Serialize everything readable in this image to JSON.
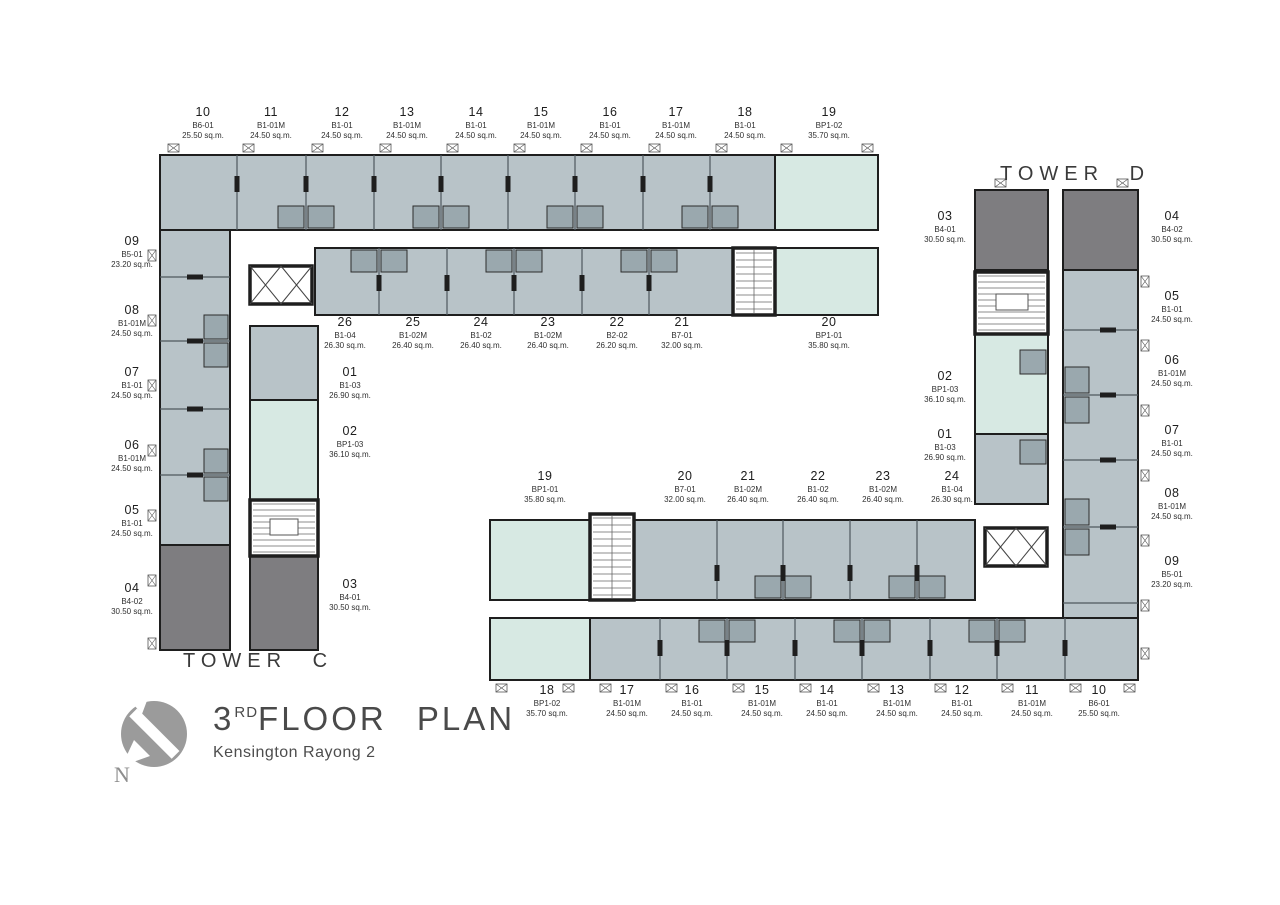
{
  "title": {
    "floor_number": "3",
    "floor_ordinal": "RD",
    "floor_text": "FLOOR  PLAN",
    "project": "Kensington Rayong 2"
  },
  "towers": {
    "c_label": "TOWER  C",
    "d_label": "TOWER  D"
  },
  "compass": {
    "letter": "N"
  },
  "colors": {
    "unit_gray": "#b8c3c8",
    "unit_mint": "#d7e9e3",
    "unit_dark": "#7e7d80",
    "wall": "#1e1e1e",
    "bath": "#9aa8ae",
    "partition": "#4e585d",
    "tread": "#666666"
  },
  "units": [
    {
      "tower": "C",
      "no": "10",
      "type": "B6-01",
      "area": "25.50 sq.m.",
      "x": 203,
      "y": 106
    },
    {
      "tower": "C",
      "no": "11",
      "type": "B1-01M",
      "area": "24.50 sq.m.",
      "x": 271,
      "y": 106
    },
    {
      "tower": "C",
      "no": "12",
      "type": "B1-01",
      "area": "24.50 sq.m.",
      "x": 342,
      "y": 106
    },
    {
      "tower": "C",
      "no": "13",
      "type": "B1-01M",
      "area": "24.50 sq.m.",
      "x": 407,
      "y": 106
    },
    {
      "tower": "C",
      "no": "14",
      "type": "B1-01",
      "area": "24.50 sq.m.",
      "x": 476,
      "y": 106
    },
    {
      "tower": "C",
      "no": "15",
      "type": "B1-01M",
      "area": "24.50 sq.m.",
      "x": 541,
      "y": 106
    },
    {
      "tower": "C",
      "no": "16",
      "type": "B1-01",
      "area": "24.50 sq.m.",
      "x": 610,
      "y": 106
    },
    {
      "tower": "C",
      "no": "17",
      "type": "B1-01M",
      "area": "24.50 sq.m.",
      "x": 676,
      "y": 106
    },
    {
      "tower": "C",
      "no": "18",
      "type": "B1-01",
      "area": "24.50 sq.m.",
      "x": 745,
      "y": 106
    },
    {
      "tower": "C",
      "no": "19",
      "type": "BP1-02",
      "area": "35.70 sq.m.",
      "x": 829,
      "y": 106
    },
    {
      "tower": "C",
      "no": "09",
      "type": "B5-01",
      "area": "23.20 sq.m.",
      "x": 132,
      "y": 235
    },
    {
      "tower": "C",
      "no": "08",
      "type": "B1-01M",
      "area": "24.50 sq.m.",
      "x": 132,
      "y": 304
    },
    {
      "tower": "C",
      "no": "07",
      "type": "B1-01",
      "area": "24.50 sq.m.",
      "x": 132,
      "y": 366
    },
    {
      "tower": "C",
      "no": "06",
      "type": "B1-01M",
      "area": "24.50 sq.m.",
      "x": 132,
      "y": 439
    },
    {
      "tower": "C",
      "no": "05",
      "type": "B1-01",
      "area": "24.50 sq.m.",
      "x": 132,
      "y": 504
    },
    {
      "tower": "C",
      "no": "04",
      "type": "B4-02",
      "area": "30.50 sq.m.",
      "x": 132,
      "y": 582
    },
    {
      "tower": "C",
      "no": "26",
      "type": "B1-04",
      "area": "26.30 sq.m.",
      "x": 345,
      "y": 316
    },
    {
      "tower": "C",
      "no": "25",
      "type": "B1-02M",
      "area": "26.40 sq.m.",
      "x": 413,
      "y": 316
    },
    {
      "tower": "C",
      "no": "24",
      "type": "B1-02",
      "area": "26.40 sq.m.",
      "x": 481,
      "y": 316
    },
    {
      "tower": "C",
      "no": "23",
      "type": "B1-02M",
      "area": "26.40 sq.m.",
      "x": 548,
      "y": 316
    },
    {
      "tower": "C",
      "no": "22",
      "type": "B2-02",
      "area": "26.20 sq.m.",
      "x": 617,
      "y": 316
    },
    {
      "tower": "C",
      "no": "21",
      "type": "B7-01",
      "area": "32.00 sq.m.",
      "x": 682,
      "y": 316
    },
    {
      "tower": "C",
      "no": "20",
      "type": "BP1-01",
      "area": "35.80 sq.m.",
      "x": 829,
      "y": 316
    },
    {
      "tower": "C",
      "no": "01",
      "type": "B1-03",
      "area": "26.90 sq.m.",
      "x": 350,
      "y": 366
    },
    {
      "tower": "C",
      "no": "02",
      "type": "BP1-03",
      "area": "36.10 sq.m.",
      "x": 350,
      "y": 425
    },
    {
      "tower": "C",
      "no": "03",
      "type": "B4-01",
      "area": "30.50 sq.m.",
      "x": 350,
      "y": 578
    },
    {
      "tower": "D",
      "no": "19",
      "type": "BP1-01",
      "area": "35.80 sq.m.",
      "x": 545,
      "y": 470
    },
    {
      "tower": "D",
      "no": "20",
      "type": "B7-01",
      "area": "32.00 sq.m.",
      "x": 685,
      "y": 470
    },
    {
      "tower": "D",
      "no": "21",
      "type": "B1-02M",
      "area": "26.40 sq.m.",
      "x": 748,
      "y": 470
    },
    {
      "tower": "D",
      "no": "22",
      "type": "B1-02",
      "area": "26.40 sq.m.",
      "x": 818,
      "y": 470
    },
    {
      "tower": "D",
      "no": "23",
      "type": "B1-02M",
      "area": "26.40 sq.m.",
      "x": 883,
      "y": 470
    },
    {
      "tower": "D",
      "no": "24",
      "type": "B1-04",
      "area": "26.30 sq.m.",
      "x": 952,
      "y": 470
    },
    {
      "tower": "D",
      "no": "18",
      "type": "BP1-02",
      "area": "35.70 sq.m.",
      "x": 547,
      "y": 684
    },
    {
      "tower": "D",
      "no": "17",
      "type": "B1-01M",
      "area": "24.50 sq.m.",
      "x": 627,
      "y": 684
    },
    {
      "tower": "D",
      "no": "16",
      "type": "B1-01",
      "area": "24.50 sq.m.",
      "x": 692,
      "y": 684
    },
    {
      "tower": "D",
      "no": "15",
      "type": "B1-01M",
      "area": "24.50 sq.m.",
      "x": 762,
      "y": 684
    },
    {
      "tower": "D",
      "no": "14",
      "type": "B1-01",
      "area": "24.50 sq.m.",
      "x": 827,
      "y": 684
    },
    {
      "tower": "D",
      "no": "13",
      "type": "B1-01M",
      "area": "24.50 sq.m.",
      "x": 897,
      "y": 684
    },
    {
      "tower": "D",
      "no": "12",
      "type": "B1-01",
      "area": "24.50 sq.m.",
      "x": 962,
      "y": 684
    },
    {
      "tower": "D",
      "no": "11",
      "type": "B1-01M",
      "area": "24.50 sq.m.",
      "x": 1032,
      "y": 684
    },
    {
      "tower": "D",
      "no": "10",
      "type": "B6-01",
      "area": "25.50 sq.m.",
      "x": 1099,
      "y": 684
    },
    {
      "tower": "D",
      "no": "03",
      "type": "B4-01",
      "area": "30.50 sq.m.",
      "x": 945,
      "y": 210
    },
    {
      "tower": "D",
      "no": "02",
      "type": "BP1-03",
      "area": "36.10 sq.m.",
      "x": 945,
      "y": 370
    },
    {
      "tower": "D",
      "no": "01",
      "type": "B1-03",
      "area": "26.90 sq.m.",
      "x": 945,
      "y": 428
    },
    {
      "tower": "D",
      "no": "04",
      "type": "B4-02",
      "area": "30.50 sq.m.",
      "x": 1172,
      "y": 210
    },
    {
      "tower": "D",
      "no": "05",
      "type": "B1-01",
      "area": "24.50 sq.m.",
      "x": 1172,
      "y": 290
    },
    {
      "tower": "D",
      "no": "06",
      "type": "B1-01M",
      "area": "24.50 sq.m.",
      "x": 1172,
      "y": 354
    },
    {
      "tower": "D",
      "no": "07",
      "type": "B1-01",
      "area": "24.50 sq.m.",
      "x": 1172,
      "y": 424
    },
    {
      "tower": "D",
      "no": "08",
      "type": "B1-01M",
      "area": "24.50 sq.m.",
      "x": 1172,
      "y": 487
    },
    {
      "tower": "D",
      "no": "09",
      "type": "B5-01",
      "area": "23.20 sq.m.",
      "x": 1172,
      "y": 555
    }
  ]
}
